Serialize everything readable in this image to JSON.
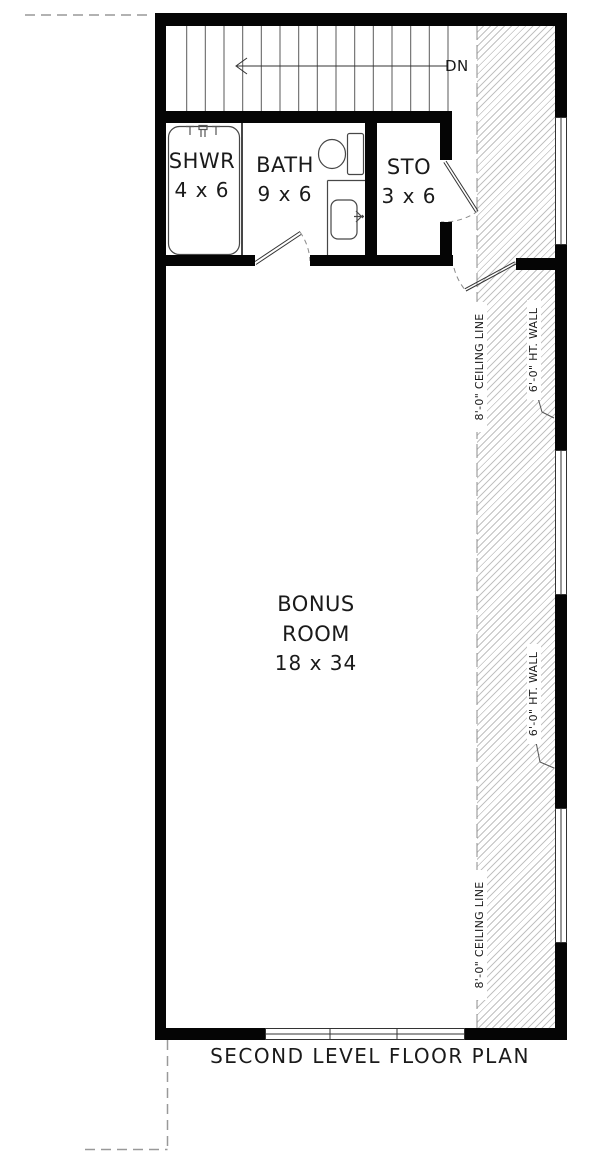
{
  "page_title": "SECOND LEVEL FLOOR PLAN",
  "stairs": {
    "down_label": "DN"
  },
  "rooms": {
    "shower": {
      "name": "SHWR",
      "size": "4 x 6"
    },
    "bath": {
      "name": "BATH",
      "size": "9 x 6"
    },
    "storage": {
      "name": "STO",
      "size": "3 x 6"
    },
    "bonus": {
      "name_line1": "BONUS",
      "name_line2": "ROOM",
      "size": "18 x 34"
    }
  },
  "annotations": {
    "ceiling_line": "8'-0\" CEILING LINE",
    "half_wall": "6'-0\" HT. WALL"
  },
  "fixtures": [
    "shower-pan",
    "shower-valve",
    "toilet",
    "vanity-sink"
  ],
  "colors": {
    "wall": "#050505",
    "hatch_line": "#c2c2c2",
    "linework": "#444444",
    "dashed_guide": "#999999",
    "text": "#1a1a1a"
  }
}
